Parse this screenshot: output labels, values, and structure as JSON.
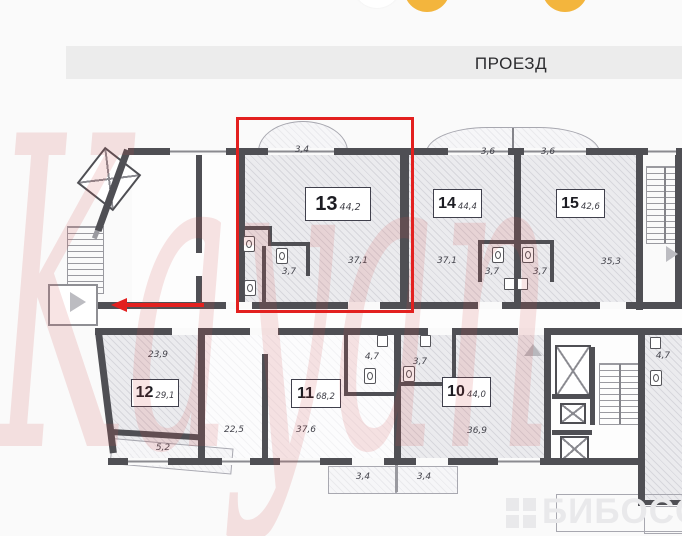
{
  "page": {
    "road_label": "ПРОЕЗД"
  },
  "watermarks": {
    "agency": "Kayan",
    "portal": "БИБОСС"
  },
  "colors": {
    "highlight": "#e3201f",
    "wall": "#4f4f54",
    "marker_yellow": "#f3b53d"
  },
  "selection": {
    "selected_apartment": "13"
  },
  "apartments": [
    {
      "number": "13",
      "total_area": "44,2",
      "living": "37,1",
      "bath": "3,7",
      "balcony": "3,4"
    },
    {
      "number": "14",
      "total_area": "44,4",
      "living": "37,1",
      "bath": "3,7",
      "balcony": "3,6"
    },
    {
      "number": "15",
      "total_area": "42,6",
      "living": "35,3",
      "bath": "3,7",
      "balcony": "3,6"
    },
    {
      "number": "12",
      "total_area": "29,1",
      "living": "23,9",
      "balcony": "5,2"
    },
    {
      "number": "11",
      "total_area": "68,2",
      "room": "22,5",
      "living": "37,6",
      "bath": "4,7",
      "balcony": "3,4"
    },
    {
      "number": "10",
      "total_area": "44,0",
      "living": "36,9",
      "bath": "3,7",
      "balcony": "3,4"
    }
  ],
  "common_areas": {
    "utility_room_area": "4,7"
  }
}
